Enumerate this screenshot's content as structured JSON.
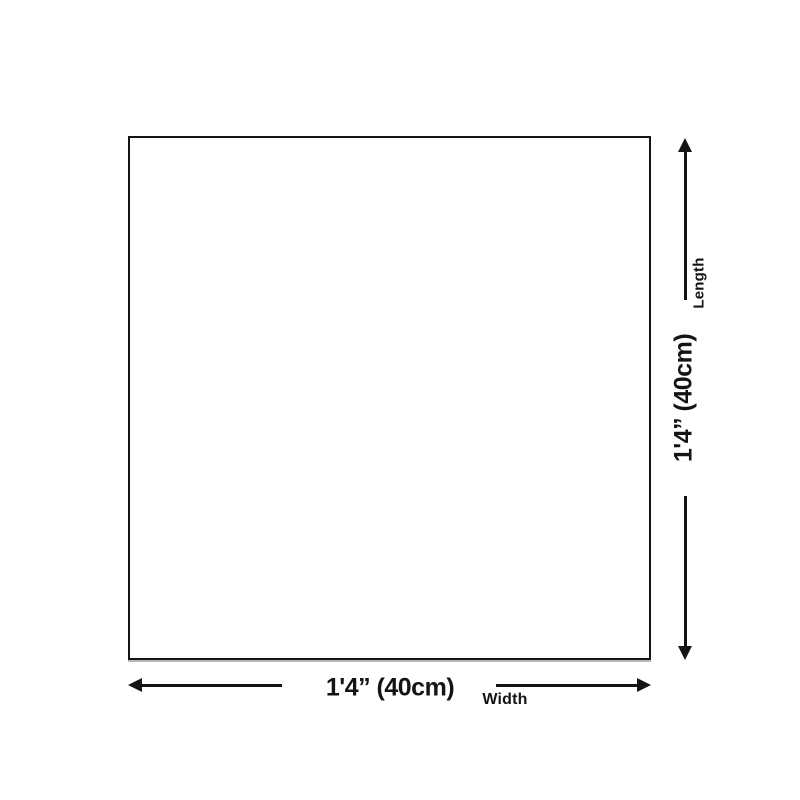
{
  "diagram": {
    "shape": "square-outline",
    "width_dimension": {
      "value": "1'4” (40cm)",
      "label": "Width"
    },
    "length_dimension": {
      "value": "1'4” (40cm)",
      "label": "Length"
    },
    "colors": {
      "background": "#ffffff",
      "line": "#141414",
      "text": "#141414",
      "shape_border": "#141414",
      "shape_fill": "#ffffff"
    }
  }
}
